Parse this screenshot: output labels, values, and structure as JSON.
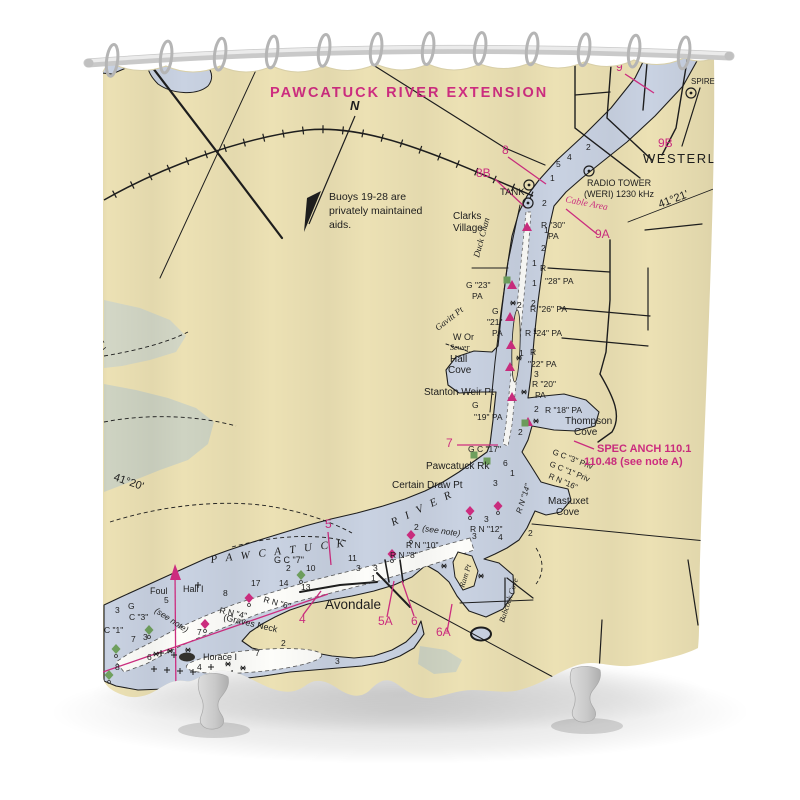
{
  "title": {
    "text": "PAWCATUCK RIVER EXTENSION"
  },
  "note": {
    "lines": [
      "Buoys 19-28 are",
      "privately maintained",
      "aids."
    ]
  },
  "colors": {
    "magenta": "#ce2d80",
    "black": "#1e1e1e",
    "cream": "#ece1b4",
    "water": "#c9d2e2",
    "marsh": "#ced3c2",
    "channel_white": "#fdfdfa",
    "green_buoy": "#6fa05e",
    "rod": "#d2d2d2",
    "hook": "#b5b5b5",
    "tub_foot": "#cecece"
  },
  "hooks_x": [
    112,
    166,
    220,
    272,
    324,
    376,
    428,
    480,
    532,
    584,
    634,
    684
  ],
  "map_labels": [
    {
      "n": "westerly-label",
      "t": "WESTERLY",
      "x": 643,
      "y": 163,
      "s": 13,
      "sp": 1.5
    },
    {
      "n": "radio-tower-label",
      "t": "RADIO TOWER",
      "x": 587,
      "y": 186,
      "s": 9
    },
    {
      "n": "radio-tower-freq",
      "t": "(WERI) 1230 kHz",
      "x": 584,
      "y": 197,
      "s": 9
    },
    {
      "n": "spire-label",
      "t": "SPIRE",
      "x": 691,
      "y": 84,
      "s": 8
    },
    {
      "n": "tank-label",
      "t": "TANK",
      "x": 500,
      "y": 195,
      "s": 9.5
    },
    {
      "t": "Clarks",
      "x": 453,
      "y": 219,
      "s": 10
    },
    {
      "t": "Village",
      "x": 453,
      "y": 231,
      "s": 10
    },
    {
      "n": "north-label",
      "t": "N",
      "x": 350,
      "y": 110,
      "s": 13,
      "i": 1,
      "b": 1
    },
    {
      "t": "Stanton Weir Pt",
      "x": 424,
      "y": 395,
      "s": 10
    },
    {
      "t": "Hall",
      "x": 450,
      "y": 362,
      "s": 10
    },
    {
      "t": "Cove",
      "x": 448,
      "y": 373,
      "s": 10
    },
    {
      "t": "Thompson",
      "x": 565,
      "y": 424,
      "s": 10
    },
    {
      "t": "Cove",
      "x": 574,
      "y": 435,
      "s": 10
    },
    {
      "t": "Pawcatuck Rk",
      "x": 426,
      "y": 469,
      "s": 10
    },
    {
      "t": "Certain Draw Pt",
      "x": 392,
      "y": 488,
      "s": 10
    },
    {
      "t": "Mastuxet",
      "x": 548,
      "y": 504,
      "s": 10
    },
    {
      "t": "Cove",
      "x": 556,
      "y": 515,
      "s": 10
    },
    {
      "t": "Avondale",
      "x": 325,
      "y": 609,
      "s": 13.5
    },
    {
      "t": "Horace I",
      "x": 203,
      "y": 660,
      "s": 9
    },
    {
      "t": "Hall I",
      "x": 183,
      "y": 592,
      "s": 9
    },
    {
      "t": "Foul",
      "x": 150,
      "y": 594,
      "s": 9
    },
    {
      "t": "(Graves Neck",
      "x": 223,
      "y": 620,
      "s": 9,
      "r": 13
    },
    {
      "t": "W Or",
      "x": 453,
      "y": 340,
      "s": 9
    },
    {
      "t": "Sewer",
      "x": 450,
      "y": 350,
      "s": 8,
      "i": 1,
      "f": 1
    },
    {
      "t": "Duck Chan",
      "x": 479,
      "y": 258,
      "s": 9,
      "i": 1,
      "f": 1,
      "r": -75
    },
    {
      "t": "Gavitt Pt",
      "x": 438,
      "y": 331,
      "s": 9,
      "i": 1,
      "f": 1,
      "r": -38
    },
    {
      "t": "Ram Pt",
      "x": 464,
      "y": 588,
      "s": 8,
      "i": 1,
      "f": 1,
      "r": -72
    },
    {
      "t": "Babcock Cove",
      "x": 504,
      "y": 623,
      "s": 8,
      "i": 1,
      "f": 1,
      "r": -72
    },
    {
      "n": "river-name-1",
      "t": "P A W C A T U C K",
      "x": 211,
      "y": 563,
      "s": 11,
      "sp": 3,
      "r": -7,
      "i": 1,
      "f": 1
    },
    {
      "n": "river-name-2",
      "t": "R I V E R",
      "x": 393,
      "y": 526,
      "s": 11,
      "sp": 3,
      "r": -26,
      "i": 1,
      "f": 1
    },
    {
      "n": "latitude-label",
      "t": "41°20'",
      "x": 113,
      "y": 480,
      "s": 11,
      "r": 19
    },
    {
      "n": "longitude-label",
      "t": "52'",
      "x": 97,
      "y": 355,
      "s": 11,
      "r": -39
    },
    {
      "n": "latitude-label-2",
      "t": "41°21'",
      "x": 660,
      "y": 208,
      "s": 11,
      "r": -21
    },
    {
      "t": "R \"30\"",
      "x": 541,
      "y": 228
    },
    {
      "t": "PA",
      "x": 548,
      "y": 239
    },
    {
      "t": "G \"23\"",
      "x": 466,
      "y": 288
    },
    {
      "t": "PA",
      "x": 472,
      "y": 299
    },
    {
      "t": "R",
      "x": 540,
      "y": 271
    },
    {
      "t": "\"28\" PA",
      "x": 545,
      "y": 284
    },
    {
      "t": "G",
      "x": 492,
      "y": 314
    },
    {
      "t": "\"21\"",
      "x": 487,
      "y": 325
    },
    {
      "t": "PA",
      "x": 492,
      "y": 336
    },
    {
      "t": "R \"26\" PA",
      "x": 530,
      "y": 312
    },
    {
      "t": "R \"24\" PA",
      "x": 525,
      "y": 336
    },
    {
      "t": "R",
      "x": 530,
      "y": 355
    },
    {
      "t": "\"22\" PA",
      "x": 528,
      "y": 367
    },
    {
      "t": "R \"20\"",
      "x": 532,
      "y": 387
    },
    {
      "t": "PA",
      "x": 535,
      "y": 398
    },
    {
      "t": "G",
      "x": 472,
      "y": 408
    },
    {
      "t": "\"19\" PA",
      "x": 474,
      "y": 420
    },
    {
      "t": "R \"18\" PA",
      "x": 545,
      "y": 413
    },
    {
      "t": "G C \"17\"",
      "x": 468,
      "y": 452
    },
    {
      "t": "G C \"3\" Priv",
      "x": 552,
      "y": 454,
      "r": 21,
      "s": 8
    },
    {
      "t": "G C \"1\" Priv",
      "x": 549,
      "y": 466,
      "r": 22,
      "s": 8
    },
    {
      "t": "R N \"16\"",
      "x": 548,
      "y": 478,
      "r": 23,
      "s": 8
    },
    {
      "t": "R N \"14\"",
      "x": 521,
      "y": 514,
      "r": -72,
      "s": 8,
      "i": 1
    },
    {
      "t": "R N \"12\"",
      "x": 470,
      "y": 532
    },
    {
      "t": "2",
      "x": 414,
      "y": 530
    },
    {
      "t": "(see note)",
      "x": 422,
      "y": 531,
      "i": 1,
      "r": 8
    },
    {
      "t": "R N \"10\"",
      "x": 406,
      "y": 548
    },
    {
      "t": "R N \"8\"",
      "x": 390,
      "y": 558
    },
    {
      "t": "G C \"7\"",
      "x": 274,
      "y": 563,
      "s": 9
    },
    {
      "t": "R N \"6\"",
      "x": 263,
      "y": 602,
      "r": 15
    },
    {
      "t": "R N \"4\"",
      "x": 219,
      "y": 613,
      "r": 12
    },
    {
      "t": "(see note)",
      "x": 154,
      "y": 612,
      "i": 1,
      "r": 33
    },
    {
      "t": "G",
      "x": 128,
      "y": 609
    },
    {
      "t": "C \"3\"",
      "x": 129,
      "y": 620
    },
    {
      "t": "C \"1\"",
      "x": 104,
      "y": 633
    },
    {
      "t": "9",
      "x": 616,
      "y": 71,
      "s": 12,
      "c": "m"
    },
    {
      "t": "9B",
      "x": 658,
      "y": 147,
      "s": 12,
      "c": "m"
    },
    {
      "t": "8",
      "x": 502,
      "y": 154,
      "s": 12,
      "c": "m"
    },
    {
      "t": "8B",
      "x": 476,
      "y": 177,
      "s": 12,
      "c": "m"
    },
    {
      "t": "9A",
      "x": 595,
      "y": 238,
      "s": 12,
      "c": "m"
    },
    {
      "t": "7",
      "x": 446,
      "y": 447,
      "s": 12,
      "c": "m"
    },
    {
      "t": "5",
      "x": 325,
      "y": 528,
      "s": 12,
      "c": "m"
    },
    {
      "t": "4",
      "x": 299,
      "y": 623,
      "s": 12,
      "c": "m"
    },
    {
      "t": "5A",
      "x": 378,
      "y": 625,
      "s": 12,
      "c": "m"
    },
    {
      "t": "6",
      "x": 411,
      "y": 625,
      "s": 12,
      "c": "m"
    },
    {
      "t": "6A",
      "x": 436,
      "y": 636,
      "s": 12,
      "c": "m"
    },
    {
      "n": "spec-anch-label",
      "t": "SPEC ANCH 110.1",
      "x": 597,
      "y": 452,
      "s": 11,
      "c": "m",
      "b": 1
    },
    {
      "n": "spec-anch-label-2",
      "t": "110.48 (see note A)",
      "x": 584,
      "y": 465,
      "s": 11,
      "c": "m",
      "b": 1
    },
    {
      "n": "cable-area-label",
      "t": "Cable Area",
      "x": 565,
      "y": 202,
      "s": 9.5,
      "c": "m",
      "i": 1,
      "f": 1,
      "r": 11
    },
    {
      "t": "2",
      "x": 586,
      "y": 150
    },
    {
      "t": "4",
      "x": 567,
      "y": 160
    },
    {
      "t": "5",
      "x": 556,
      "y": 167
    },
    {
      "t": "1",
      "x": 550,
      "y": 181
    },
    {
      "t": "2",
      "x": 542,
      "y": 206
    },
    {
      "t": "1",
      "x": 544,
      "y": 233
    },
    {
      "t": "2",
      "x": 541,
      "y": 251
    },
    {
      "t": "1",
      "x": 532,
      "y": 266
    },
    {
      "t": "1",
      "x": 532,
      "y": 286
    },
    {
      "t": "2",
      "x": 531,
      "y": 306
    },
    {
      "t": "2",
      "x": 517,
      "y": 308
    },
    {
      "t": "1",
      "x": 533,
      "y": 334
    },
    {
      "t": "1",
      "x": 519,
      "y": 356
    },
    {
      "t": "3",
      "x": 534,
      "y": 377
    },
    {
      "t": "2",
      "x": 534,
      "y": 412
    },
    {
      "t": "2",
      "x": 518,
      "y": 435
    },
    {
      "t": "6",
      "x": 503,
      "y": 466
    },
    {
      "t": "1",
      "x": 510,
      "y": 476
    },
    {
      "t": "3",
      "x": 493,
      "y": 486
    },
    {
      "t": "3",
      "x": 484,
      "y": 522
    },
    {
      "t": "2",
      "x": 528,
      "y": 536
    },
    {
      "t": "4",
      "x": 498,
      "y": 540
    },
    {
      "t": "3",
      "x": 472,
      "y": 539
    },
    {
      "t": "11",
      "x": 348,
      "y": 561
    },
    {
      "t": "3",
      "x": 356,
      "y": 571
    },
    {
      "t": "3",
      "x": 373,
      "y": 571
    },
    {
      "t": "2",
      "x": 286,
      "y": 571
    },
    {
      "t": "10",
      "x": 306,
      "y": 571
    },
    {
      "t": "1",
      "x": 371,
      "y": 581
    },
    {
      "t": "17",
      "x": 251,
      "y": 586
    },
    {
      "t": "14",
      "x": 279,
      "y": 586
    },
    {
      "t": "13",
      "x": 301,
      "y": 590
    },
    {
      "t": "8",
      "x": 223,
      "y": 596
    },
    {
      "t": "5",
      "x": 164,
      "y": 603
    },
    {
      "t": "3",
      "x": 115,
      "y": 613
    },
    {
      "t": "7",
      "x": 131,
      "y": 642
    },
    {
      "t": "3",
      "x": 143,
      "y": 640
    },
    {
      "t": "6",
      "x": 147,
      "y": 660
    },
    {
      "t": "8",
      "x": 115,
      "y": 670
    },
    {
      "t": "7",
      "x": 197,
      "y": 635
    },
    {
      "t": "4",
      "x": 197,
      "y": 670
    },
    {
      "t": "2",
      "x": 281,
      "y": 646
    },
    {
      "t": "7",
      "x": 255,
      "y": 656
    },
    {
      "t": "4",
      "x": 229,
      "y": 676
    },
    {
      "t": "3",
      "x": 335,
      "y": 664
    }
  ],
  "symbols": [
    {
      "t": "tri",
      "x": 527,
      "y": 227
    },
    {
      "t": "tri",
      "x": 512,
      "y": 285
    },
    {
      "t": "tri",
      "x": 510,
      "y": 317
    },
    {
      "t": "tri",
      "x": 511,
      "y": 345
    },
    {
      "t": "tri",
      "x": 510,
      "y": 367
    },
    {
      "t": "tri",
      "x": 512,
      "y": 397
    },
    {
      "t": "tri",
      "x": 528,
      "y": 422
    },
    {
      "t": "nun",
      "x": 498,
      "y": 506
    },
    {
      "t": "nun",
      "x": 470,
      "y": 511
    },
    {
      "t": "nun",
      "x": 411,
      "y": 535
    },
    {
      "t": "nun",
      "x": 392,
      "y": 554
    },
    {
      "t": "nun",
      "x": 249,
      "y": 598
    },
    {
      "t": "nun",
      "x": 205,
      "y": 624
    },
    {
      "t": "can",
      "x": 149,
      "y": 630
    },
    {
      "t": "can",
      "x": 116,
      "y": 649
    },
    {
      "t": "can",
      "x": 109,
      "y": 675
    },
    {
      "t": "can",
      "x": 301,
      "y": 575
    },
    {
      "t": "sqg",
      "x": 507,
      "y": 280
    },
    {
      "t": "sqg",
      "x": 525,
      "y": 423
    },
    {
      "t": "sqg",
      "x": 474,
      "y": 455
    },
    {
      "t": "sqg",
      "x": 487,
      "y": 461
    },
    {
      "t": "tower",
      "x": 691,
      "y": 93
    },
    {
      "t": "tower",
      "x": 589,
      "y": 171
    },
    {
      "t": "tower",
      "x": 529,
      "y": 185
    },
    {
      "t": "tower",
      "x": 528,
      "y": 203
    },
    {
      "t": "star",
      "x": 513,
      "y": 303
    },
    {
      "t": "star",
      "x": 519,
      "y": 358
    },
    {
      "t": "star",
      "x": 524,
      "y": 392
    },
    {
      "t": "star",
      "x": 536,
      "y": 421
    },
    {
      "t": "star",
      "x": 444,
      "y": 566
    },
    {
      "t": "star",
      "x": 481,
      "y": 576
    },
    {
      "t": "star",
      "x": 188,
      "y": 650
    },
    {
      "t": "star",
      "x": 170,
      "y": 651
    },
    {
      "t": "star",
      "x": 228,
      "y": 664
    },
    {
      "t": "star",
      "x": 156,
      "y": 654
    },
    {
      "t": "star",
      "x": 243,
      "y": 668
    },
    {
      "t": "plus",
      "x": 198,
      "y": 585
    },
    {
      "t": "plus",
      "x": 154,
      "y": 669
    },
    {
      "t": "plus",
      "x": 167,
      "y": 670
    },
    {
      "t": "plus",
      "x": 180,
      "y": 671
    },
    {
      "t": "plus",
      "x": 193,
      "y": 672
    },
    {
      "t": "plus",
      "x": 161,
      "y": 653
    },
    {
      "t": "plus",
      "x": 174,
      "y": 655
    },
    {
      "t": "plus",
      "x": 211,
      "y": 667
    }
  ],
  "magenta_lines": [
    [
      625,
      74,
      654,
      93
    ],
    [
      508,
      157,
      546,
      184
    ],
    [
      495,
      179,
      526,
      208
    ],
    [
      597,
      234,
      566,
      209
    ],
    [
      457,
      445,
      498,
      445
    ],
    [
      594,
      449,
      574,
      441
    ],
    [
      328,
      532,
      331,
      565
    ],
    [
      303,
      615,
      321,
      591
    ],
    [
      387,
      617,
      394,
      581
    ],
    [
      414,
      616,
      402,
      581
    ],
    [
      447,
      632,
      452,
      604
    ],
    [
      100,
      673,
      328,
      594
    ],
    [
      175,
      572,
      176,
      702
    ]
  ]
}
